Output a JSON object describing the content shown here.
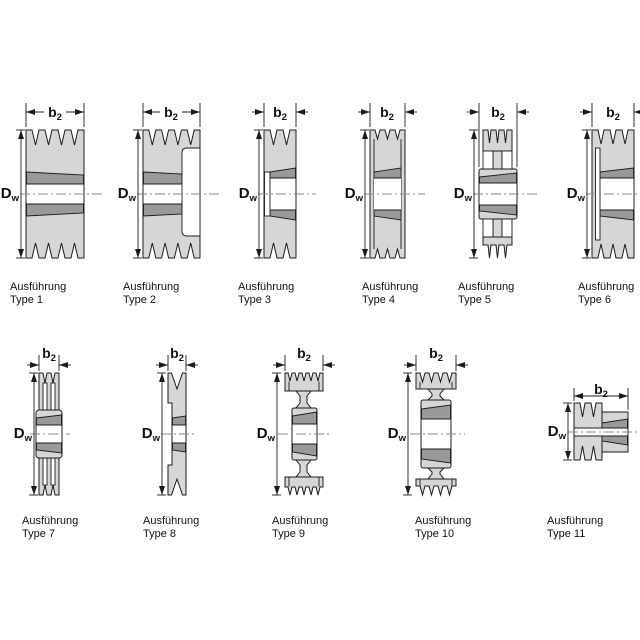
{
  "colors": {
    "body": "#d6d6d6",
    "band": "#999999",
    "bore": "#ffffff",
    "outline": "#1c1c1c",
    "centerline": "#8a8a8a"
  },
  "dims": {
    "width_symbol": "b",
    "width_subscript": "2",
    "diameter_symbol": "D",
    "diameter_subscript": "w"
  },
  "types": [
    {
      "caption_line1": "Ausführung",
      "caption_line2": "Type 1"
    },
    {
      "caption_line1": "Ausführung",
      "caption_line2": "Type 2"
    },
    {
      "caption_line1": "Ausführung",
      "caption_line2": "Type 3"
    },
    {
      "caption_line1": "Ausführung",
      "caption_line2": "Type 4"
    },
    {
      "caption_line1": "Ausführung",
      "caption_line2": "Type 5"
    },
    {
      "caption_line1": "Ausführung",
      "caption_line2": "Type 6"
    },
    {
      "caption_line1": "Ausführung",
      "caption_line2": "Type 7"
    },
    {
      "caption_line1": "Ausführung",
      "caption_line2": "Type 8"
    },
    {
      "caption_line1": "Ausführung",
      "caption_line2": "Type 9"
    },
    {
      "caption_line1": "Ausführung",
      "caption_line2": "Type 10"
    },
    {
      "caption_line1": "Ausführung",
      "caption_line2": "Type 11"
    }
  ]
}
